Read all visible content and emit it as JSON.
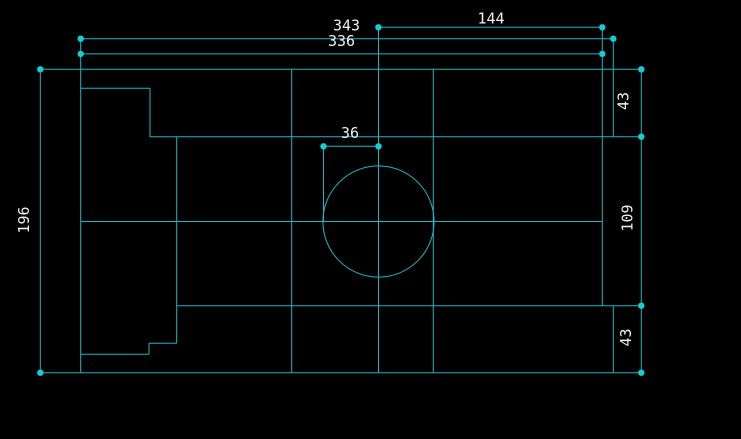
{
  "viewport": {
    "width": 741,
    "height": 439,
    "background": "#000000"
  },
  "style": {
    "line_color": "#1fb6c4",
    "dot_color": "#10cfd6",
    "text_color": "#f0f0f0",
    "line_width": 1,
    "dot_radius": 3.2,
    "font_size": 15
  },
  "drawing": {
    "kind": "cad-part-view-with-linear-dimensions",
    "dimensions": [
      {
        "value": "343",
        "orientation": "horizontal",
        "line": [
          80.7,
          38.7,
          613.3,
          38.7
        ],
        "label_x": 346.5,
        "label_y": 25.5,
        "label_rotation": 0
      },
      {
        "value": "336",
        "orientation": "horizontal",
        "line": [
          80.7,
          53.9,
          602.3,
          53.9
        ],
        "label_x": 341.5,
        "label_y": 41,
        "label_rotation": 0
      },
      {
        "value": "144",
        "orientation": "horizontal",
        "line": [
          378.4,
          27.3,
          602.3,
          27.3
        ],
        "label_x": 491,
        "label_y": 18.5,
        "label_rotation": 0
      },
      {
        "value": "36",
        "orientation": "horizontal",
        "line": [
          323.5,
          146.3,
          378.5,
          146.3
        ],
        "label_x": 350,
        "label_y": 133,
        "label_rotation": 0
      },
      {
        "value": "196",
        "orientation": "vertical",
        "line": [
          40.3,
          69.3,
          40.3,
          372.7
        ],
        "label_x": 24,
        "label_y": 220,
        "label_rotation": -90
      },
      {
        "value": "43",
        "orientation": "vertical",
        "line": [
          641.3,
          69.3,
          641.3,
          136.7
        ],
        "label_x": 623.5,
        "label_y": 101,
        "label_rotation": -90
      },
      {
        "value": "109",
        "orientation": "vertical",
        "line": [
          641.3,
          136.7,
          641.3,
          305.7
        ],
        "label_x": 627.5,
        "label_y": 218,
        "label_rotation": -90
      },
      {
        "value": "43",
        "orientation": "vertical",
        "line": [
          641.3,
          305.7,
          641.3,
          372.7
        ],
        "label_x": 626,
        "label_y": 337.5,
        "label_rotation": -90
      }
    ],
    "geometry_lines": [
      {
        "name": "top-edge",
        "p": [
          40.3,
          69.3,
          641.3,
          69.3
        ]
      },
      {
        "name": "notch-top-edge",
        "p": [
          80.7,
          88.3,
          150,
          88.3
        ]
      },
      {
        "name": "upper-row-line",
        "p": [
          150,
          136.7,
          641.3,
          136.7
        ]
      },
      {
        "name": "horizontal-centerline",
        "p": [
          80.7,
          221.5,
          602.3,
          221.5
        ]
      },
      {
        "name": "lower-row-line",
        "p": [
          176.7,
          305.7,
          641.3,
          305.7
        ]
      },
      {
        "name": "step-upper-edge",
        "p": [
          149,
          343.3,
          176.7,
          343.3
        ]
      },
      {
        "name": "step-lower-edge",
        "p": [
          80.7,
          354.3,
          149,
          354.3
        ]
      },
      {
        "name": "bottom-edge",
        "p": [
          40.3,
          372.7,
          641.3,
          372.7
        ]
      },
      {
        "name": "left-edge",
        "p": [
          80.7,
          38.7,
          80.7,
          372.7
        ]
      },
      {
        "name": "notch-vertical-edge",
        "p": [
          150,
          88.3,
          150,
          136.7
        ]
      },
      {
        "name": "step-vertical-edge",
        "p": [
          149,
          343.3,
          149,
          354.3
        ]
      },
      {
        "name": "interior-vertical-left",
        "p": [
          176.7,
          136.7,
          176.7,
          343.3
        ]
      },
      {
        "name": "interior-vertical-mid",
        "p": [
          291.7,
          69.3,
          291.7,
          372.7
        ]
      },
      {
        "name": "radius-extension-line",
        "p": [
          323.5,
          146.3,
          323.5,
          221.5
        ]
      },
      {
        "name": "circle-vertical-centerline",
        "p": [
          378.5,
          27.3,
          378.5,
          372.7
        ]
      },
      {
        "name": "circle-tangent-vertical",
        "p": [
          433.3,
          69.3,
          433.3,
          372.7
        ]
      },
      {
        "name": "interior-vertical-right",
        "p": [
          602.3,
          27.3,
          602.3,
          305.7
        ]
      },
      {
        "name": "right-edge-upper",
        "p": [
          613.3,
          38.7,
          613.3,
          136.7
        ]
      },
      {
        "name": "right-edge-lower",
        "p": [
          613.3,
          305.7,
          613.3,
          372.7
        ]
      }
    ],
    "circle": {
      "cx": 378.5,
      "cy": 221.5,
      "r": 55.6
    },
    "dots": [
      [
        80.7,
        38.7
      ],
      [
        613.3,
        38.7
      ],
      [
        80.7,
        53.9
      ],
      [
        602.3,
        53.9
      ],
      [
        378.4,
        27.3
      ],
      [
        602.3,
        27.3
      ],
      [
        323.5,
        146.3
      ],
      [
        378.5,
        146.3
      ],
      [
        40.3,
        69.3
      ],
      [
        40.3,
        372.7
      ],
      [
        641.3,
        69.3
      ],
      [
        641.3,
        136.7
      ],
      [
        641.3,
        305.7
      ],
      [
        641.3,
        372.7
      ]
    ]
  }
}
